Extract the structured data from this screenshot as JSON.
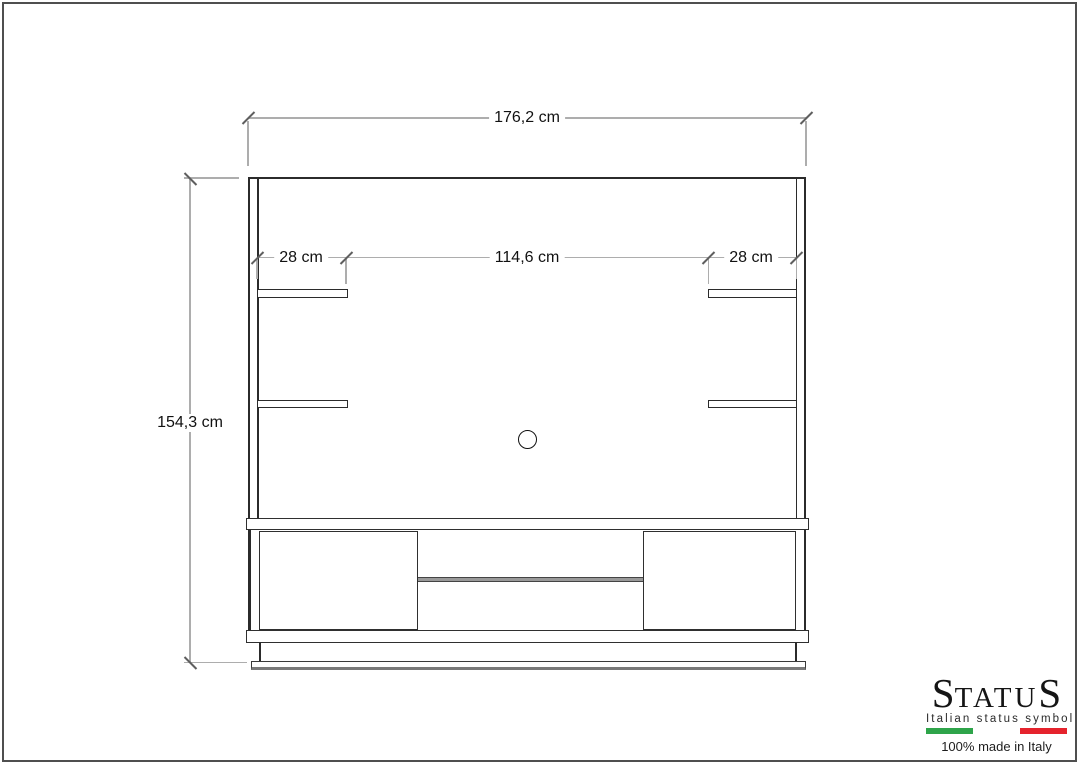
{
  "drawing": {
    "type": "furniture technical drawing - TV wall unit front elevation",
    "dimensions": {
      "total_width": "176,2 cm",
      "left_shelf_width": "28 cm",
      "center_width": "114,6 cm",
      "right_shelf_width": "28 cm",
      "total_height": "154,3 cm"
    }
  },
  "logo": {
    "brand_first": "S",
    "brand_mid": "TATU",
    "brand_last": "S",
    "tagline": "Italian status symbol",
    "made_in": "100% made in Italy",
    "flag_green": "#2ea44a",
    "flag_white": "#ffffff",
    "flag_red": "#e5232d"
  },
  "colors": {
    "furniture_line": "#2b2b2b",
    "dimension_line": "#adadad",
    "tick_mark": "#5f5f5f",
    "page_border": "#4f4f4f"
  }
}
